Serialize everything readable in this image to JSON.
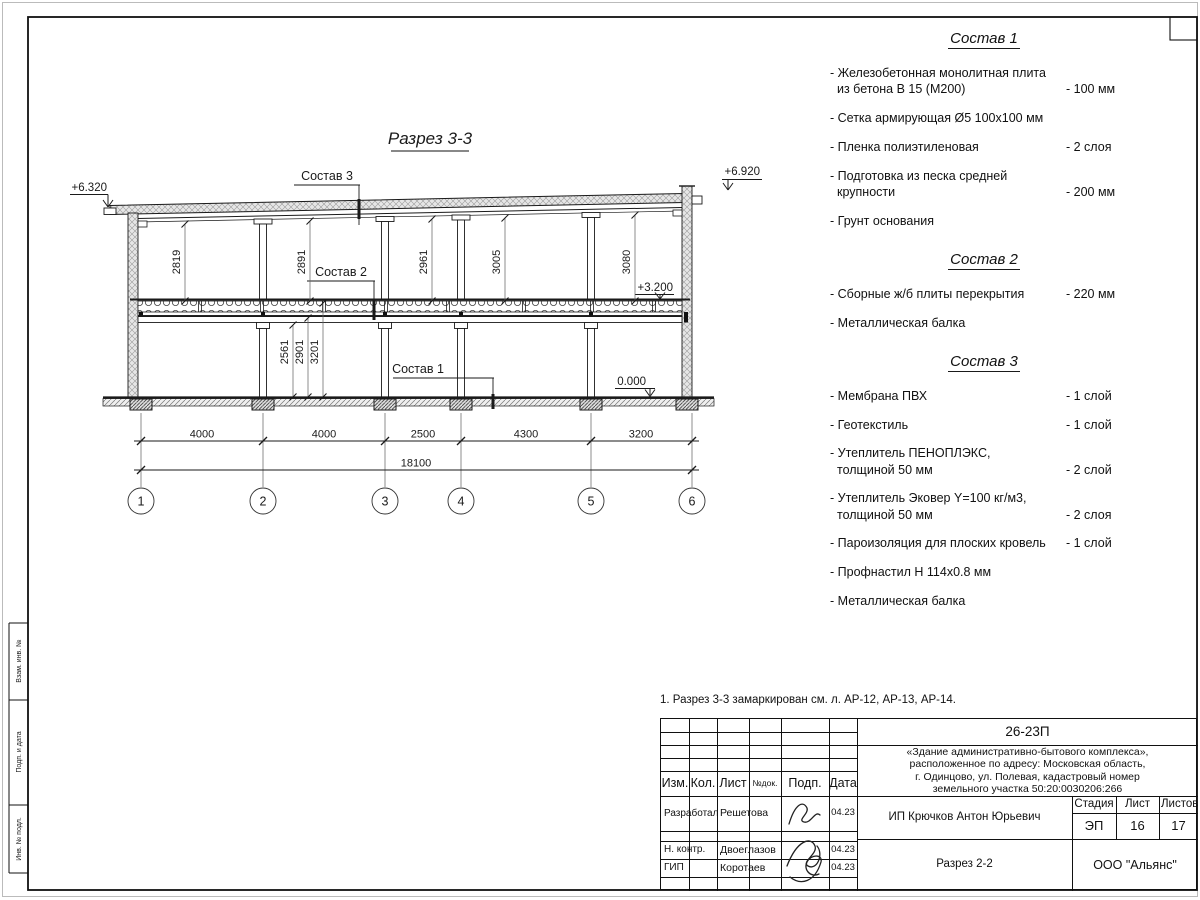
{
  "drawing": {
    "title": "Разрез 3-3",
    "elev_left": "+6.320",
    "elev_right": "+6.920",
    "elev_floor": "+3.200",
    "elev_zero": "0.000",
    "label_sostav1": "Состав 1",
    "label_sostav2": "Состав 2",
    "label_sostav3": "Состав 3",
    "upper_dims": [
      "2819",
      "2891",
      "2961",
      "3005",
      "3080"
    ],
    "lower_dims": [
      "2561",
      "2901",
      "3201"
    ],
    "span_dims": [
      "4000",
      "4000",
      "2500",
      "4300",
      "3200"
    ],
    "total_dim": "18100",
    "axes": [
      "1",
      "2",
      "3",
      "4",
      "5",
      "6"
    ]
  },
  "specs": {
    "s1": {
      "title": "Состав 1",
      "items": [
        {
          "l1": "- Железобетонная  монолитная плита",
          "l2": "из бетона В 15 (М200)",
          "v": "- 100 мм"
        },
        {
          "l1": "- Сетка армирующая Ø5 100х100 мм",
          "l2": "",
          "v": ""
        },
        {
          "l1": "- Пленка полиэтиленовая",
          "l2": "",
          "v": "-  2 слоя"
        },
        {
          "l1": "- Подготовка из песка средней",
          "l2": "крупности",
          "v": "- 200 мм"
        },
        {
          "l1": "- Грунт основания",
          "l2": "",
          "v": ""
        }
      ]
    },
    "s2": {
      "title": "Состав 2",
      "items": [
        {
          "l1": "- Сборные ж/б плиты перекрытия",
          "l2": "",
          "v": "- 220 мм"
        },
        {
          "l1": "- Металлическая балка",
          "l2": "",
          "v": ""
        }
      ]
    },
    "s3": {
      "title": "Состав 3",
      "items": [
        {
          "l1": "- Мембрана ПВХ",
          "l2": "",
          "v": "- 1 слой"
        },
        {
          "l1": "- Геотекстиль",
          "l2": "",
          "v": "- 1 слой"
        },
        {
          "l1": "- Утеплитель ПЕНОПЛЭКС,",
          "l2": "толщиной 50 мм",
          "v": "- 2 слой"
        },
        {
          "l1": "- Утеплитель Эковер Y=100 кг/м3,",
          "l2": "толщиной 50 мм",
          "v": "- 2 слоя"
        },
        {
          "l1": "- Пароизоляция для плоских кровель",
          "l2": "",
          "v": "- 1 слой"
        },
        {
          "l1": "- Профнастил Н 114х0.8 мм",
          "l2": "",
          "v": ""
        },
        {
          "l1": "- Металлическая балка",
          "l2": "",
          "v": ""
        }
      ]
    }
  },
  "note": "1. Разрез 3-3 замаркирован см. л. АР-12, АР-13, АР-14.",
  "titleblock": {
    "doc_code": "26-23П",
    "project_line1": "«Здание административно-бытового комплекса»,",
    "project_line2": "расположенное по адресу: Московская область,",
    "project_line3": "г. Одинцово, ул. Полевая, кадастровый номер",
    "project_line4": "земельного участка 50:20:0030206:266",
    "header": {
      "izm": "Изм.",
      "kol": "Кол.",
      "list": "Лист",
      "ndok": "№док.",
      "podp": "Подп.",
      "data": "Дата"
    },
    "rows": [
      {
        "role": "Разработал",
        "name": "Решетова",
        "date": "04.23"
      },
      {
        "role": "Н. контр.",
        "name": "Двоеглазов",
        "date": "04.23"
      },
      {
        "role": "ГИП",
        "name": "Коротаев",
        "date": "04.23"
      }
    ],
    "client": "ИП Крючков Антон Юрьевич",
    "sheet_title": "Разрез 2-2",
    "company": "ООО \"Альянс\"",
    "stage_label": "Стадия",
    "stage": "ЭП",
    "sheet_label": "Лист",
    "sheet": "16",
    "sheets_label": "Листов",
    "sheets": "17"
  },
  "frame": {
    "stamp1": "Взам. инв. №",
    "stamp2": "Подп. и дата",
    "stamp3": "Инв. № подл."
  }
}
